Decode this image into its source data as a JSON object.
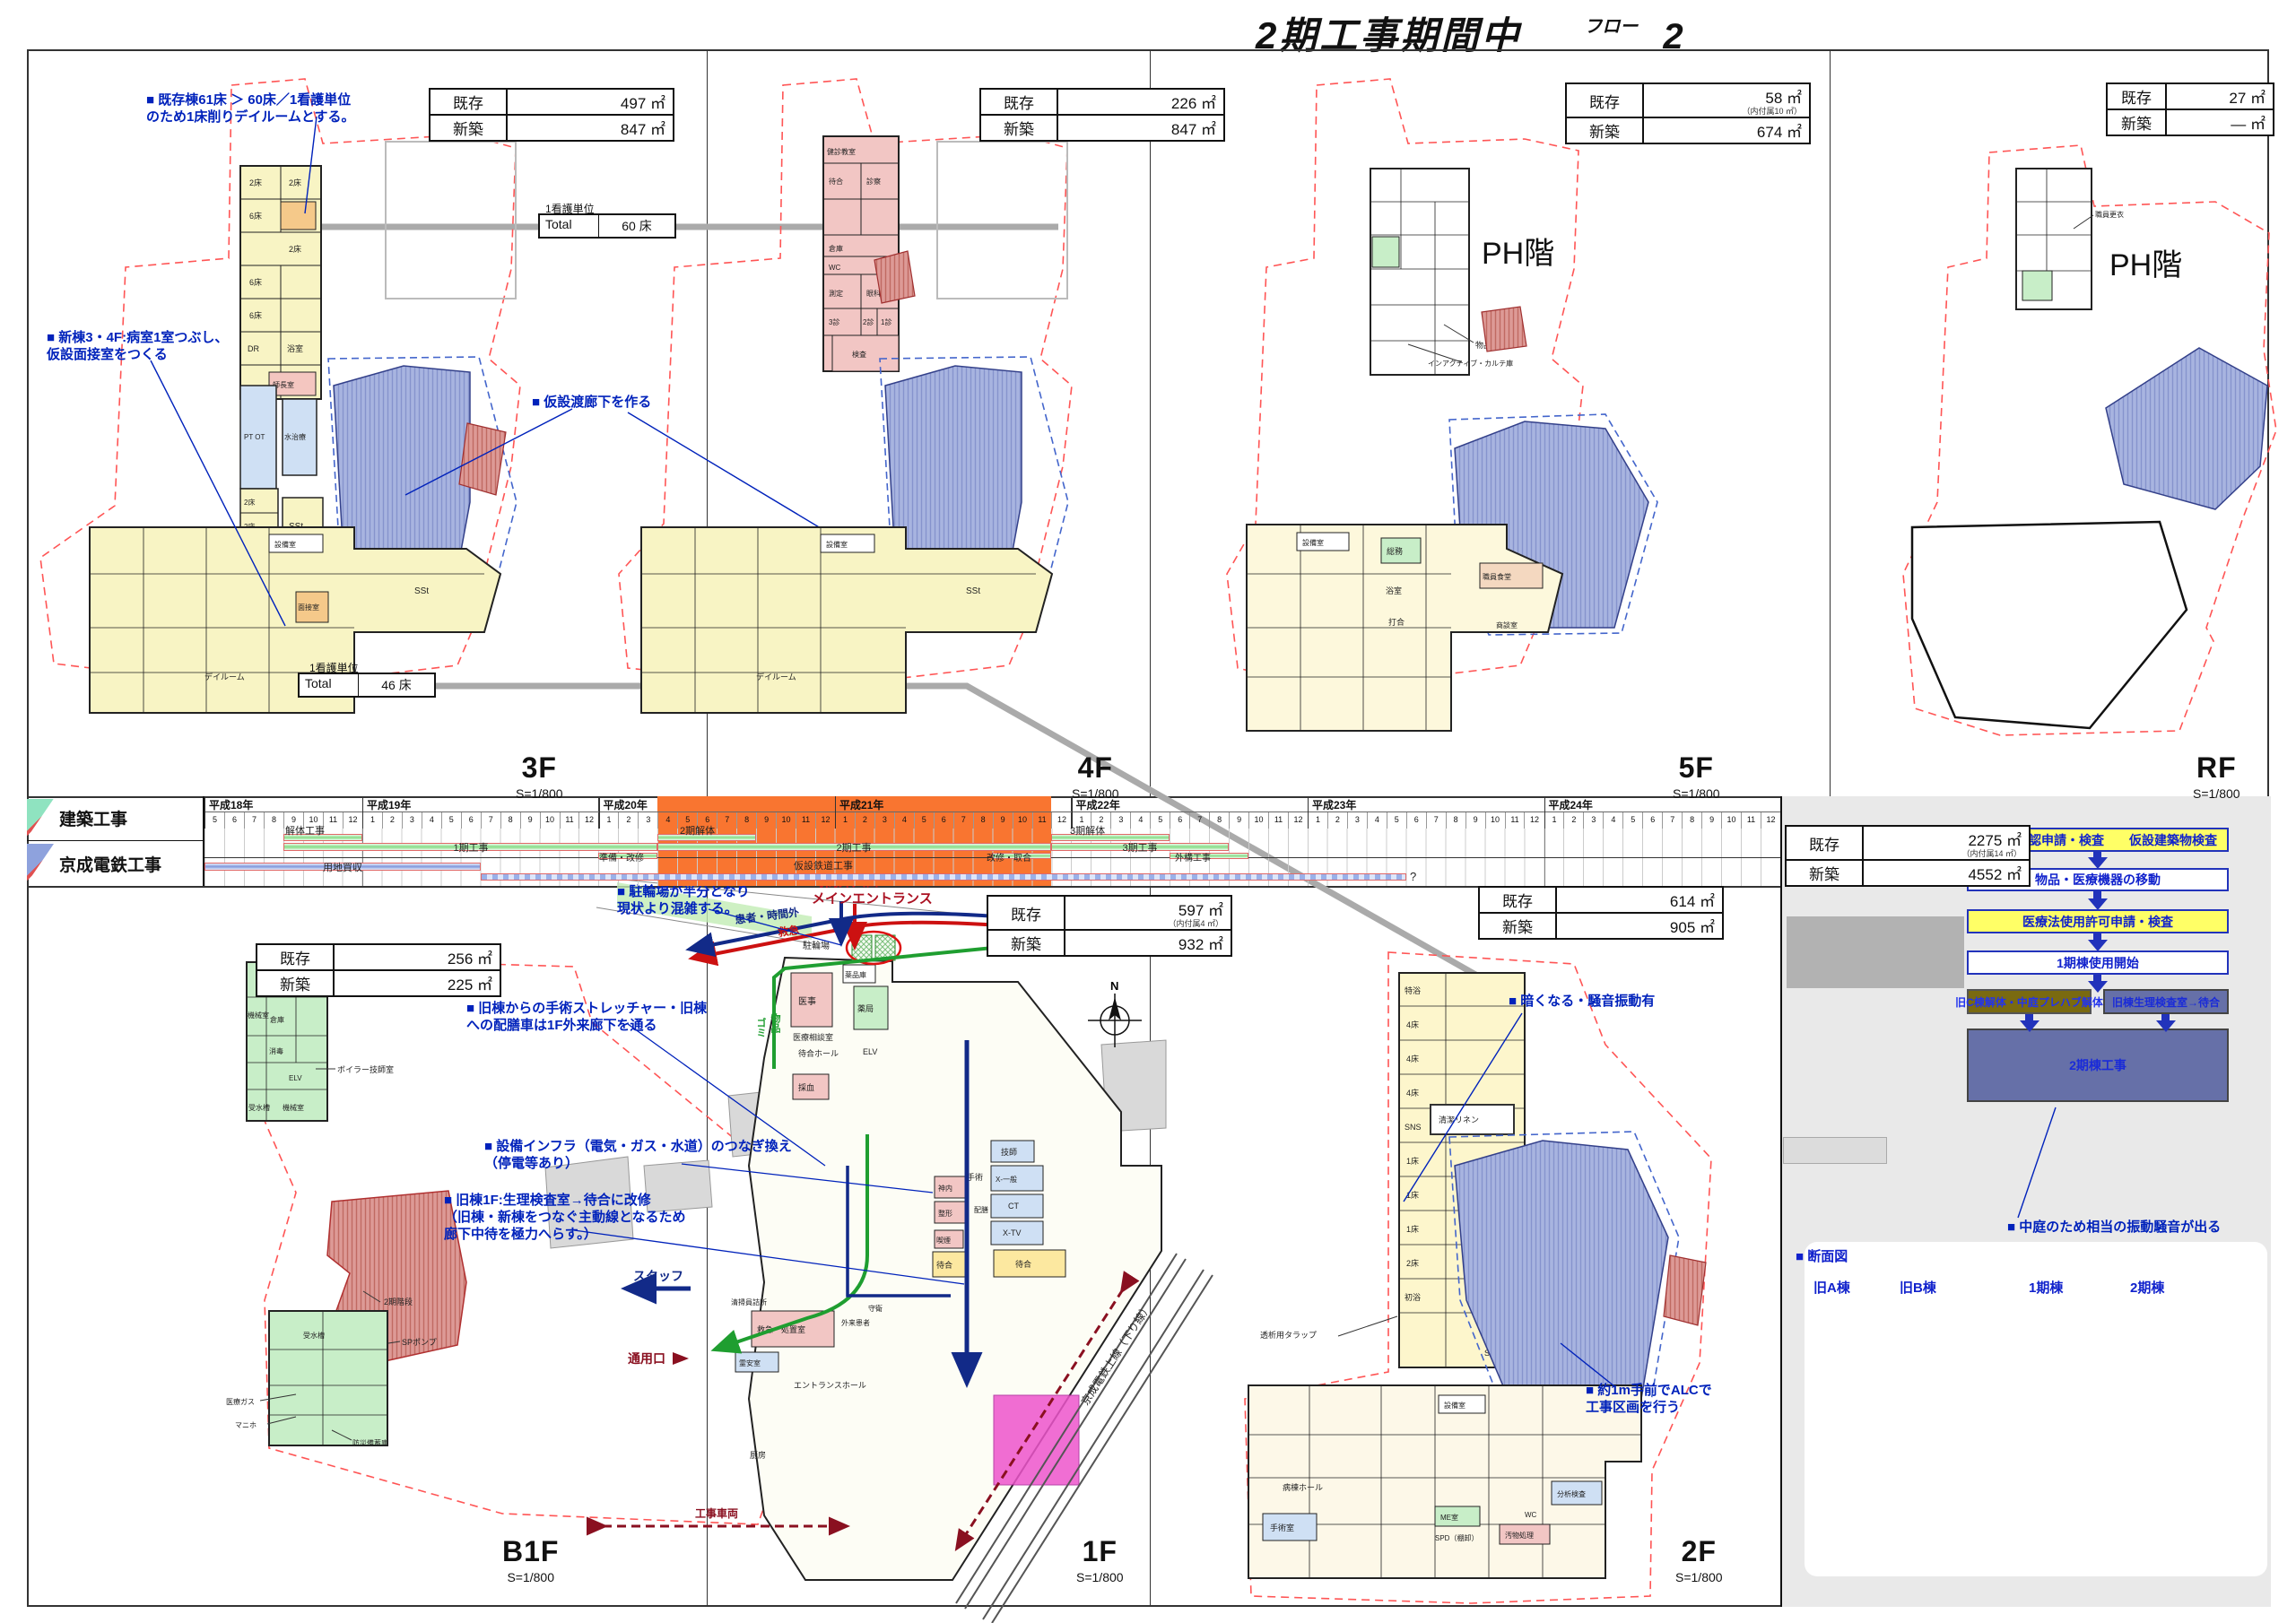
{
  "title": {
    "main": "2期工事期間中",
    "flow_label": "フロー",
    "flow_num": "2"
  },
  "common": {
    "scale": "S=1/800",
    "exist": "既存",
    "new": "新築",
    "compass": "N"
  },
  "panels": {
    "f3": {
      "label": "3F",
      "area": {
        "exist": "497 ㎡",
        "new": "847 ㎡"
      },
      "ann_beds": "■ 既存棟61床 ＞ 60床／1看護単位\nのため1床削りデイルームとする。",
      "ann_room": "■ 新棟3・4F:病室1室つぶし、\n仮設面接室をつくる",
      "ann_corridor": "■ 仮設渡廊下を作る",
      "nurse_top": {
        "caption": "1看護単位",
        "name": "Total",
        "value": "60 床"
      },
      "nurse_bottom": {
        "caption": "1看護単位",
        "name": "Total",
        "value": "46 床"
      },
      "rooms": {
        "r1": "2床",
        "r2": "2床",
        "r3": "6床",
        "r4": "2床",
        "r5": "6床",
        "r6": "6床",
        "r7": "DR",
        "r8": "浴室",
        "r9": "師長室",
        "r10": "PT OT",
        "r11": "水治療",
        "r12": "2床",
        "r13": "2床",
        "r14": "1床",
        "r15": "SSt",
        "r16": "設備室",
        "r17": "SSt",
        "r18": "デイルーム",
        "r19": "面接室"
      }
    },
    "f4": {
      "label": "4F",
      "area": {
        "exist": "226 ㎡",
        "new": "847 ㎡"
      },
      "rooms": {
        "r1": "健診教室",
        "r2": "待合",
        "r3": "診察",
        "r4": "倉庫",
        "r5": "WC",
        "r6": "測定",
        "r7": "眼科",
        "r8": "3診",
        "r9": "2診",
        "r10": "1診",
        "r11": "検査",
        "r12": "設備室",
        "r13": "SSt",
        "r14": "デイルーム"
      }
    },
    "f5": {
      "label": "5F",
      "ph": "PH階",
      "area": {
        "exist": "58 ㎡",
        "exist_note": "（内付属10 ㎡）",
        "new": "674 ㎡"
      },
      "rooms": {
        "r1": "設備室",
        "r2": "総務",
        "r3": "職員食堂",
        "r4": "浴室",
        "r5": "打合",
        "r6": "商談室",
        "r7": "物品庫",
        "r8": "インアクティブ・カルテ庫"
      }
    },
    "rf": {
      "label": "RF",
      "ph": "PH階",
      "area": {
        "exist": "27 ㎡",
        "new": "― ㎡"
      },
      "rooms": {
        "r1": "職員更衣"
      }
    },
    "b1f": {
      "label": "B1F",
      "area": {
        "exist": "256 ㎡",
        "new": "225 ㎡"
      },
      "rooms": {
        "r1": "電気室",
        "r2": "機械室",
        "r3": "倉庫",
        "r4": "消毒",
        "r5": "ELV",
        "r6": "受水槽",
        "r7": "機械室",
        "r8": "ボイラー技師室",
        "r9": "2期階段",
        "r10": "SPポンプ",
        "r11": "受水槽",
        "r12": "医療ガス",
        "r13": "マニホ",
        "r14": "防災備蓄庫"
      }
    },
    "f1": {
      "label": "1F",
      "area": {
        "exist": "597 ㎡",
        "exist_note": "（内付属4 ㎡）",
        "new": "932 ㎡"
      },
      "ann_bike": "■ 駐輪場が半分となり\n現状より混雑する。",
      "ann_entrance": "時間外入口\nメインエントランス",
      "ann_stretcher": "■ 旧棟からの手術ストレッチャー・旧棟\nへの配膳車は1F外来廊下を通る",
      "ann_infra": "■ 設備インフラ（電気・ガス・水道）のつなぎ換え\n（停電等あり）",
      "ann_renov": "■ 旧棟1F:生理検査室→待合に改修\n（旧棟・新棟をつなぐ主動線となるため\n廊下中待を極力へらす。）",
      "routes": {
        "patient": "患者・時間外",
        "emergency": "救急",
        "goods1": "ゴミ",
        "goods2": "物品",
        "staff": "スタッフ",
        "gate": "通用口",
        "vehicle": "工事車両",
        "railway": "京成電鉄上線（下り線）"
      },
      "rooms": {
        "bike": "駐輪場",
        "r1": "医事",
        "r2": "薬局",
        "r3": "薬品庫",
        "r4": "医療相談室",
        "r5": "待合ホール",
        "r6": "ELV",
        "r7": "採血",
        "r8": "技師",
        "r9": "手術",
        "r10": "X-一般",
        "r11": "CT",
        "r12": "X-TV",
        "r13": "神内",
        "r14": "整形",
        "r15": "喫煙",
        "r16": "待合",
        "r17": "待合",
        "r18": "配膳",
        "r19": "清掃員詰所",
        "r20": "救急・処置室",
        "r21": "霊安室",
        "r22": "外来患者",
        "r23": "守衛",
        "r24": "エントランスホール",
        "r25": "厨房"
      }
    },
    "f2": {
      "label": "2F",
      "area": {
        "exist": "614 ㎡",
        "new": "905 ㎡"
      },
      "ann_dark": "■ 暗くなる・騒音振動有",
      "ann_alc": "■ 約1m手前でALCで\n工事区画を行う",
      "rooms": {
        "r1": "特浴",
        "r2": "4床",
        "r3": "4床",
        "r4": "4床",
        "r5": "SNS",
        "r6": "1床",
        "r7": "1床",
        "r8": "1床",
        "r9": "2床",
        "r10": "初浴",
        "icu1": "ICU",
        "icu2": "6床",
        "r11": "SSt",
        "r12": "清潔リネン",
        "r13": "透析用タラップ",
        "r14": "病棟ホール",
        "r15": "手術室",
        "r16": "ME室",
        "r17": "SPD（棚卸）",
        "r18": "汚物処理",
        "r19": "分析検査",
        "r20": "WC",
        "r21": "設備室"
      }
    }
  },
  "gantt": {
    "rows": {
      "r1": "建築工事",
      "r2": "京成電鉄工事"
    },
    "years": [
      {
        "label": "平成18年",
        "months": [
          "5",
          "6",
          "7",
          "8",
          "9",
          "10",
          "11",
          "12"
        ]
      },
      {
        "label": "平成19年",
        "months": [
          "1",
          "2",
          "3",
          "4",
          "5",
          "6",
          "7",
          "8",
          "9",
          "10",
          "11",
          "12"
        ]
      },
      {
        "label": "平成20年",
        "months": [
          "1",
          "2",
          "3",
          "4",
          "5",
          "6",
          "7",
          "8",
          "9",
          "10",
          "11",
          "12"
        ]
      },
      {
        "label": "平成21年",
        "months": [
          "1",
          "2",
          "3",
          "4",
          "5",
          "6",
          "7",
          "8",
          "9",
          "10",
          "11",
          "12"
        ]
      },
      {
        "label": "平成22年",
        "months": [
          "1",
          "2",
          "3",
          "4",
          "5",
          "6",
          "7",
          "8",
          "9",
          "10",
          "11",
          "12"
        ]
      },
      {
        "label": "平成23年",
        "months": [
          "1",
          "2",
          "3",
          "4",
          "5",
          "6",
          "7",
          "8",
          "9",
          "10",
          "11",
          "12"
        ]
      },
      {
        "label": "平成24年",
        "months": [
          "1",
          "2",
          "3",
          "4",
          "5",
          "6",
          "7",
          "8",
          "9",
          "10",
          "11",
          "12"
        ]
      }
    ],
    "bars": {
      "b1": "解体工事",
      "b2": "1期工事",
      "b3": "準備・改修",
      "b4": "2期解体",
      "b5": "2期工事",
      "b6": "改修・取合",
      "b7": "3期解体",
      "b8": "3期工事",
      "b9": "外構工事",
      "b10": "用地買収",
      "b11": "仮設鉄道工事",
      "unknown": "?"
    }
  },
  "flow": {
    "area": {
      "exist": "2275 ㎡",
      "exist_note": "（内付属14 ㎡）",
      "new": "4552 ㎡"
    },
    "steps": {
      "s1": "仮使用承認申請・検査　　仮設建築物検査",
      "s2": "物品・医療機器の移動",
      "s3": "医療法使用許可申請・検査",
      "s4": "1期棟使用開始",
      "s5a": "旧C棟解体・中庭プレハブ解体",
      "s5b": "旧棟生理検査室→待合",
      "s6": "2期棟工事"
    },
    "ann": "■ 中庭のため相当の振動騒音が出る"
  },
  "section": {
    "title": "■ 断面図",
    "buildings": {
      "a": "旧A棟",
      "b": "旧B棟",
      "p1": "1期棟",
      "p2": "2期棟"
    },
    "rooms": {
      "a1": "糖尿外来",
      "a2": "眼科",
      "a3": "病室",
      "a4": "病室",
      "a5": "医事・カルテ",
      "a6": "薬局",
      "a7": "外来",
      "a8": "機械室",
      "a9": "階段EV",
      "b1": "リハビリ",
      "b2": "NS",
      "b3": "NS",
      "b4": "放射線・検査",
      "stair": "スタッフ階段",
      "c1": "機械室",
      "c2": "医局",
      "c3": "病室",
      "c4": "NS",
      "c5": "病室",
      "c6": "NS",
      "c7": "眼科",
      "c8": "手術・生理・放射線・分析",
      "c9": "厨房",
      "c10": "救急",
      "c11a": "受水槽",
      "c11b": "SPポンプ",
      "c12": "階段EV EV EV",
      "d1": "病室",
      "d2": "病室",
      "d3": "外来"
    }
  }
}
